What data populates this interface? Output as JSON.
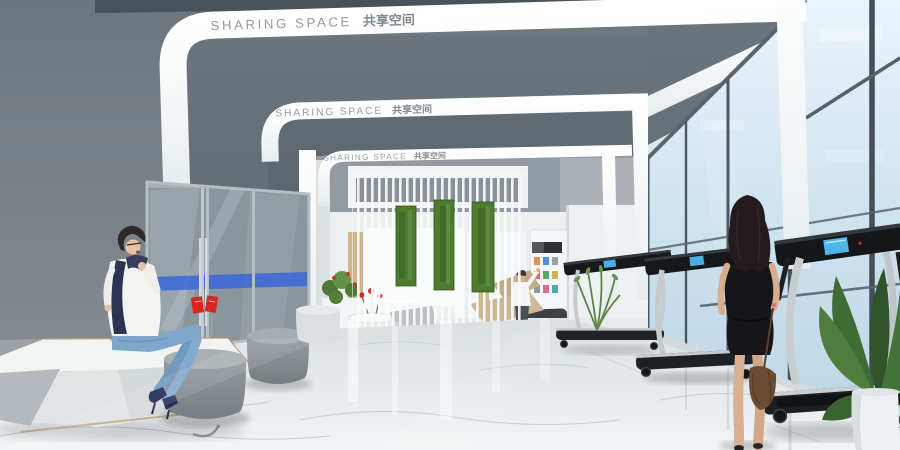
{
  "scene": {
    "type": "architectural interior rendering",
    "name": "Sharing space lounge and fitness corridor"
  },
  "signage": {
    "arch1_en": "SHARING SPACE",
    "arch1_zh": "共享空间",
    "arch2_en": "SHARING SPACE",
    "arch2_zh": "共享空间",
    "arch3_en": "SHARING SPACE",
    "arch3_zh": "共享空间"
  },
  "palette": {
    "left_wall_gray": "#79828a",
    "soffit_gray": "#636e76",
    "band_white": "#f8fbfb",
    "sign_text_gray": "#8d979e",
    "sky_blue": "#cfe3f0",
    "moss_green": "#4d7c2e",
    "marble_floor": "#e9edee",
    "accent_red": "#d6281f",
    "door_glass_blue_band": "#3a66d9",
    "treadmill_black": "#1b1e22",
    "wood_tan": "#c9b28a",
    "denim_blue": "#7ba3cc",
    "dress_black": "#17171b",
    "handbag_brown": "#6e4e36",
    "plant_green": "#4e7a35"
  }
}
